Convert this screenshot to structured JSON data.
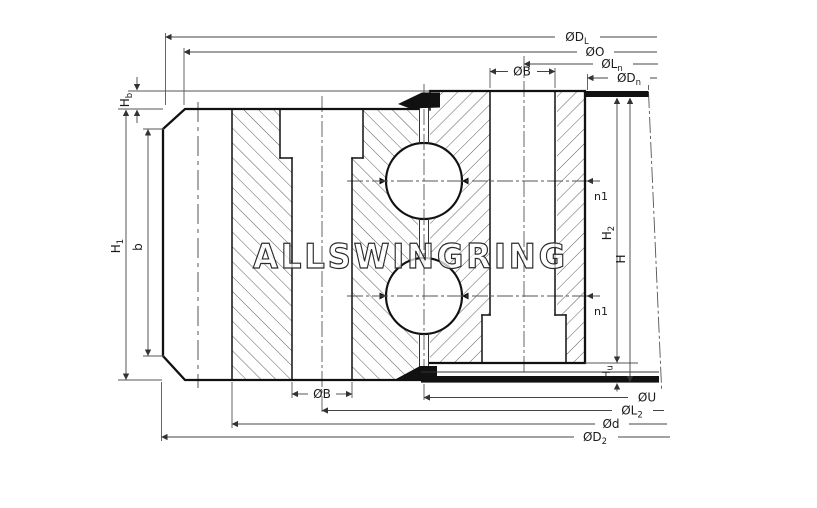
{
  "drawing": {
    "title": "slewing-ring-bearing-cross-section",
    "watermark": "ALLSWINGRING",
    "colors": {
      "line": "#111111",
      "dim": "#444444",
      "centerline": "#555555",
      "seal": "#111111",
      "bg": "#ffffff"
    },
    "labels": {
      "dL": {
        "main": "ØD",
        "sub": "L"
      },
      "o": {
        "main": "ØO",
        "sub": ""
      },
      "ln": {
        "main": "ØL",
        "sub": "n"
      },
      "b_top": {
        "main": "ØB",
        "sub": ""
      },
      "dn": {
        "main": "ØD",
        "sub": "n"
      },
      "hb": {
        "main": "H",
        "sub": "b"
      },
      "h1": {
        "main": "H",
        "sub": "1"
      },
      "b_left": {
        "main": "b",
        "sub": ""
      },
      "n1_upper": {
        "main": "n1",
        "sub": ""
      },
      "n1_lower": {
        "main": "n1",
        "sub": ""
      },
      "h2": {
        "main": "H",
        "sub": "2"
      },
      "h": {
        "main": "H",
        "sub": ""
      },
      "hu": {
        "main": "H",
        "sub": "u"
      },
      "b_bottom": {
        "main": "ØB",
        "sub": ""
      },
      "u": {
        "main": "ØU",
        "sub": ""
      },
      "l2": {
        "main": "ØL",
        "sub": "2"
      },
      "d": {
        "main": "Ød",
        "sub": ""
      },
      "d2": {
        "main": "ØD",
        "sub": "2"
      }
    }
  }
}
